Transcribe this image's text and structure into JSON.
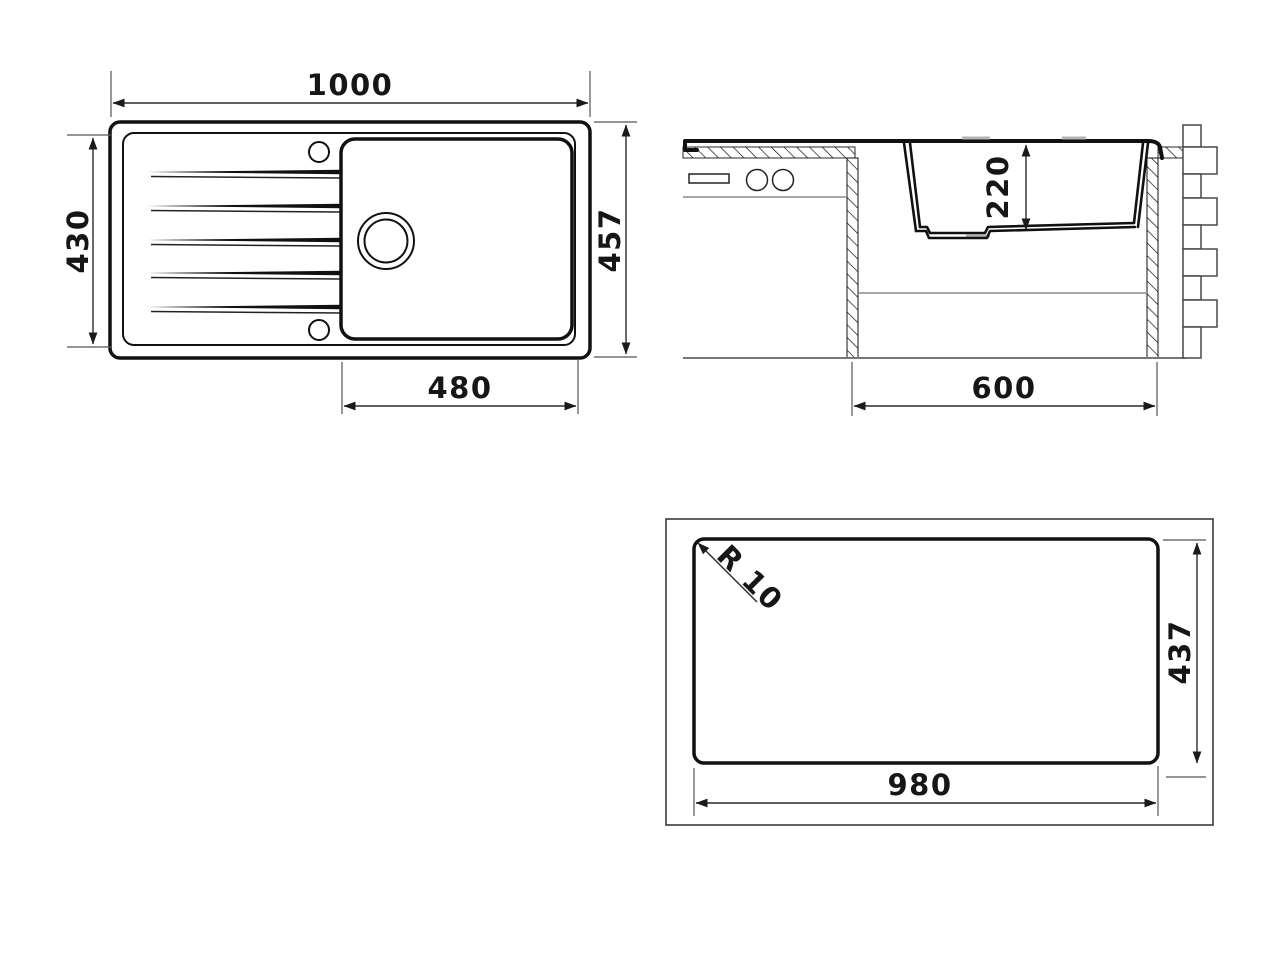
{
  "drawing": {
    "subject": "kitchen-sink-technical-drawing",
    "background": "#ffffff",
    "line_color": "#111111",
    "dim_color": "#2a2a2a",
    "views": {
      "plan": {
        "name": "top-view",
        "dims": {
          "overall_width": "1000",
          "drainboard_depth": "430",
          "overall_depth": "457",
          "bowl_width": "480"
        }
      },
      "section": {
        "name": "front-section-view",
        "dims": {
          "bowl_depth": "220",
          "cabinet_width": "600"
        }
      },
      "cutout": {
        "name": "worktop-cutout-view",
        "dims": {
          "corner_radius": "R 10",
          "cutout_depth": "437",
          "cutout_width": "980"
        }
      }
    }
  }
}
